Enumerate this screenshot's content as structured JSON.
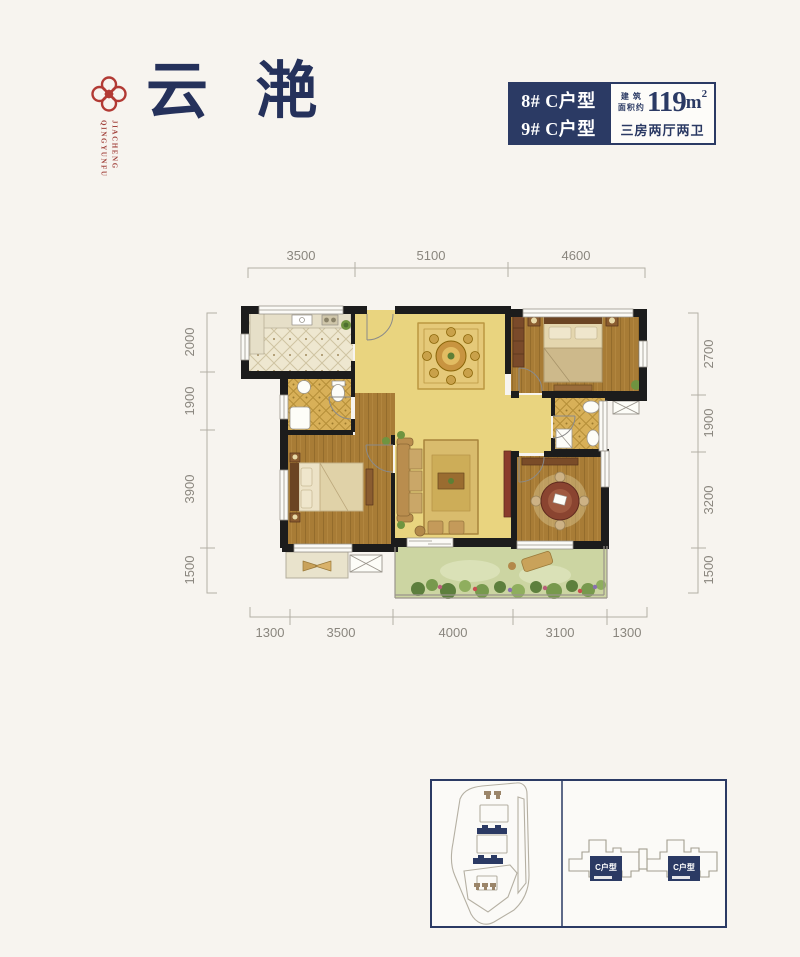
{
  "header": {
    "logo": {
      "vertical_left": "QINGYUNFU",
      "vertical_right": "JIACHENG"
    },
    "title": "云 滟",
    "info_box": {
      "units": [
        "8# C户型",
        "9# C户型"
      ],
      "area_label_top": "建 筑",
      "area_label_bottom": "面积约",
      "area_value": "119",
      "area_unit": "m",
      "area_sup": "2",
      "layout_spec": "三房两厅两卫"
    }
  },
  "floorplan": {
    "dims_top": [
      "3500",
      "5100",
      "4600"
    ],
    "dims_bottom": [
      "1300",
      "3500",
      "4000",
      "3100",
      "1300"
    ],
    "dims_left": [
      "2000",
      "1900",
      "3900",
      "1500"
    ],
    "dims_right": [
      "2700",
      "1900",
      "3200",
      "1500"
    ]
  },
  "locator": {
    "unit_label": "C户型"
  },
  "colors": {
    "navy": "#2b3a64",
    "title_navy": "#25315b",
    "brand_red": "#b23a34",
    "dim_text": "#8a867e",
    "wood_floor": "#a87c36",
    "gold_tile": "#d8b058",
    "yellow_floor": "#e9d47f",
    "cream_tile": "#eee7d0",
    "balcony_green": "#ccd5a2",
    "wall_black": "#1c1c1c"
  }
}
